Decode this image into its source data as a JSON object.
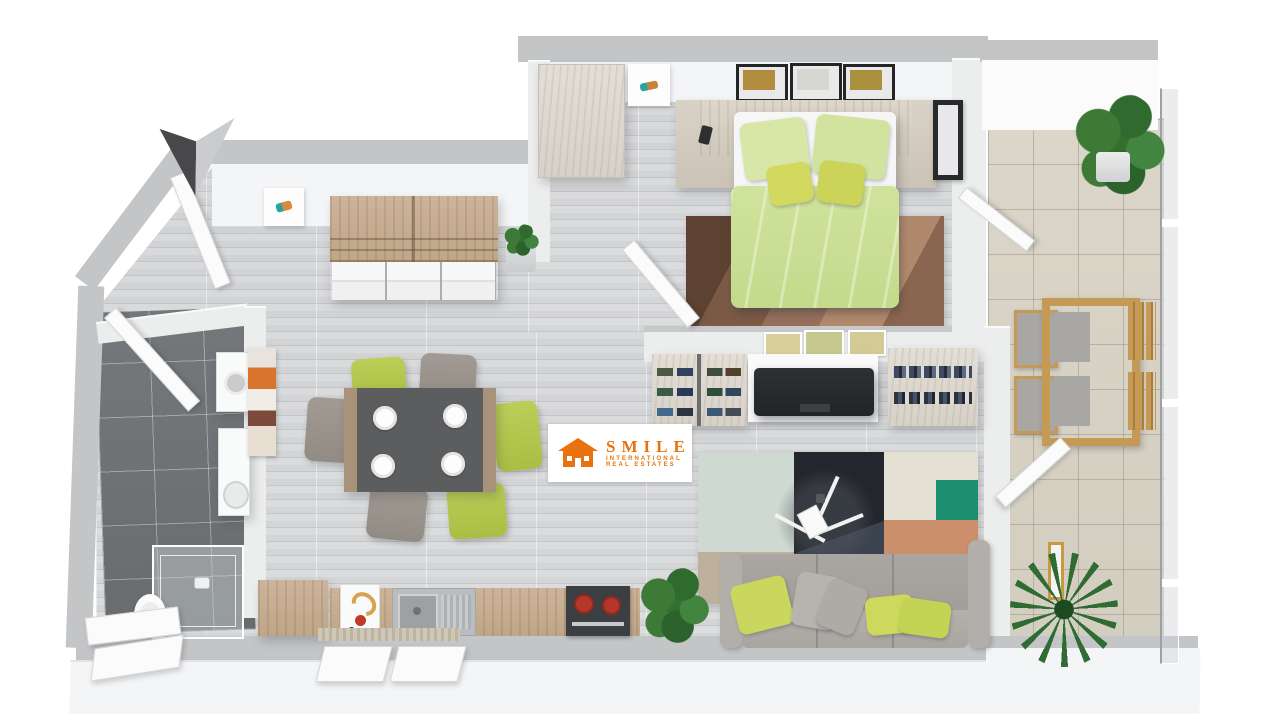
{
  "watermark": {
    "brand": "SMILE",
    "line1": "INTERNATIONAL",
    "line2": "REAL ESTATES"
  },
  "palette": {
    "logo-orange": "#e8720e",
    "wall-gray": "#c3c5c7",
    "wall-white": "#eceded",
    "floor-wood": "#d8d9db",
    "bath-tile": "#6f7376",
    "balcony-tile": "#d8d3c6",
    "duvet-green": "#cfe39c",
    "pillow-green": "#c9d75f",
    "sofa-gray": "#a7a39f",
    "rug-teal": "#1d8f70",
    "rug-navy": "#262a33",
    "rug-orange": "#cb8f6b",
    "bed-rug-brown": "#7a5a46",
    "wood-light": "#cbb79d",
    "whitewash": "#ded8cf"
  },
  "scene": {
    "type": "3d-floor-plan-top-view",
    "annotations": [
      "north-arrow"
    ],
    "rooms": [
      {
        "name": "entry-hall",
        "floor": "light-gray-wood",
        "items": [
          "entry-door-open",
          "sideboard-shelf",
          "potted-succulent",
          "small-wall-art"
        ]
      },
      {
        "name": "bedroom",
        "floor": "light-gray-wood",
        "items": [
          "double-bed-green-bedding",
          "headboard-console-nightstands",
          "wardrobe",
          "three-framed-pictures",
          "black-framed-picture",
          "brown-rug",
          "door-open",
          "balcony-door-open"
        ]
      },
      {
        "name": "living-dining",
        "floor": "light-gray-wood",
        "items": [
          "dining-table-dark-top",
          "six-chairs-green-gray",
          "white-plates",
          "abstract-wall-art",
          "shoe-rack",
          "tv-on-console",
          "three-small-pictures",
          "bookshelf",
          "patchwork-rug",
          "tripod-floor-lamp",
          "gray-sofa-green-pillows",
          "floor-plant"
        ]
      },
      {
        "name": "kitchen",
        "floor": "light-gray-wood",
        "items": [
          "wood-counter",
          "cutting-board",
          "sink-with-drainer",
          "stove-red-pots",
          "open-window",
          "floor-plant"
        ]
      },
      {
        "name": "bathroom",
        "floor": "dark-gray-tile",
        "items": [
          "shower-glass-enclosure",
          "toilet",
          "vanity-sink",
          "washing-machine",
          "tilted-window",
          "door-open"
        ]
      },
      {
        "name": "balcony",
        "floor": "beige-tile",
        "items": [
          "wooden-table-set-four-chairs",
          "large-potted-plant",
          "palm-plant",
          "glass-railing",
          "gold-framed-mirror"
        ]
      }
    ]
  }
}
